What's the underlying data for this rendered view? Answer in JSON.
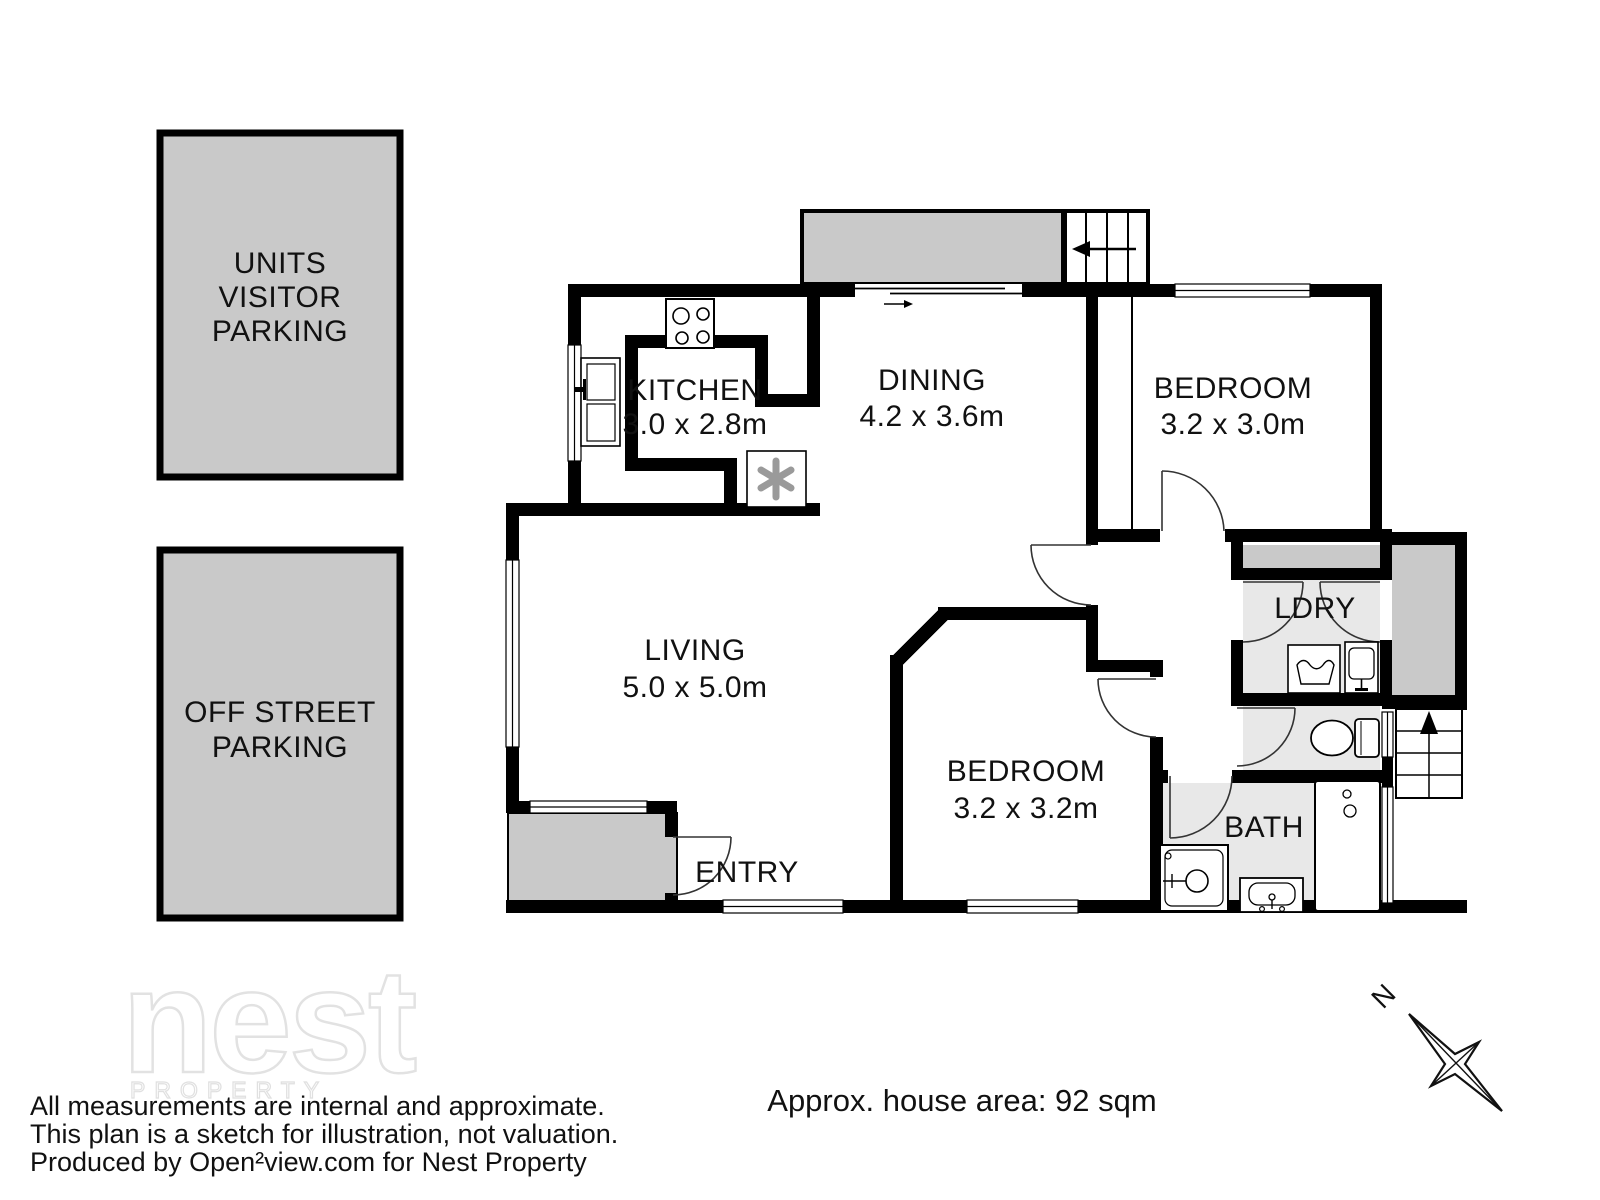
{
  "plan": {
    "rooms": {
      "kitchen": {
        "name": "KITCHEN",
        "dims": "3.0 x 2.8m"
      },
      "dining": {
        "name": "DINING",
        "dims": "4.2 x 3.6m"
      },
      "bedroom1": {
        "name": "BEDROOM",
        "dims": "3.2 x 3.0m"
      },
      "living": {
        "name": "LIVING",
        "dims": "5.0 x 5.0m"
      },
      "bedroom2": {
        "name": "BEDROOM",
        "dims": "3.2 x 3.2m"
      },
      "laundry": {
        "name": "LDRY"
      },
      "bath": {
        "name": "BATH"
      },
      "entry": {
        "name": "ENTRY"
      }
    },
    "compass": {
      "north_label": "N"
    }
  },
  "parking": {
    "units_visitor": {
      "line1": "UNITS",
      "line2": "VISITOR",
      "line3": "PARKING"
    },
    "off_street": {
      "line1": "OFF STREET",
      "line2": "PARKING"
    }
  },
  "watermark": {
    "brand": "nest",
    "subtitle": "PROPERTY"
  },
  "footer": {
    "area_text": "Approx. house area: 92 sqm",
    "disclaimer1": "All measurements are internal and approximate.",
    "disclaimer2": "This plan is a sketch for illustration, not valuation.",
    "disclaimer3": "Produced by Open²view.com for Nest Property"
  },
  "colors": {
    "wall": "#000000",
    "outdoor_gray": "#c9c9c9",
    "wet_floor_gray": "#e8e8e8"
  }
}
